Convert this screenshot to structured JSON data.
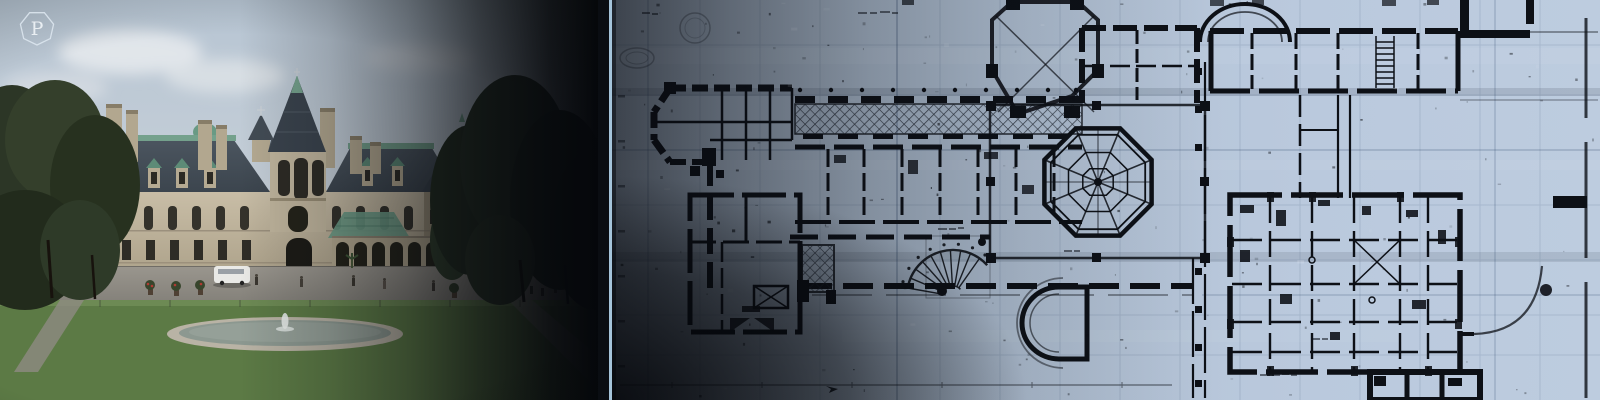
{
  "badge": {
    "letter": "P"
  },
  "scene": {
    "photo_label": "estate-photograph",
    "plan_label": "floorplan-blueprint"
  },
  "colors": {
    "background": "#0a0d12",
    "divider_line": "#a5c4da",
    "plan_paper": "#b7c7db",
    "plan_ink": "#0d1016",
    "sky": "#b7c5d3",
    "stone": "#c8bda6",
    "roof_slate": "#46505a",
    "verdigris": "#74a18c",
    "lawn_light": "#6e8d54",
    "lawn_dark": "#547140",
    "fountain_stone": "#b9b3a5"
  }
}
